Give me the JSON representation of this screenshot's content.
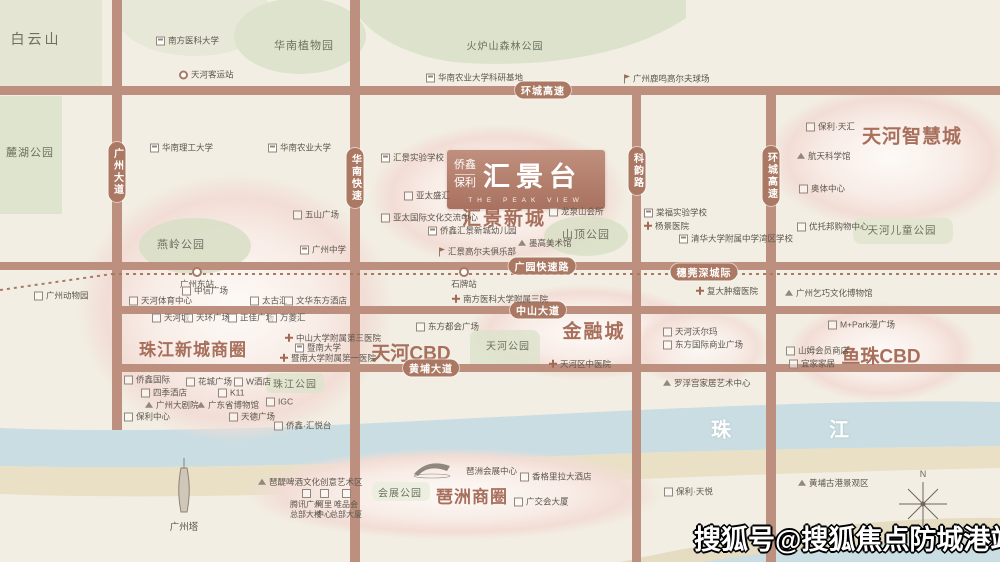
{
  "watermark": {
    "text": "搜狐号@搜狐焦点防城港站"
  },
  "compass": {
    "north_label": "N"
  },
  "logo": {
    "brand_top": "侨鑫",
    "brand_bottom": "保利",
    "name": "汇景台",
    "subtitle": "THE PEAK VIEW"
  },
  "colors": {
    "background": "#f2eee3",
    "road": "#bd8f7e",
    "road_pill": "#ab7963",
    "district_text": "#a8705c",
    "park_green": "#dfe4ce",
    "blob_pink": "#f2ddd5",
    "river": "#c9dde2",
    "sand": "#e9e0c6",
    "poi_text": "#5d574e",
    "watermark_fill": "#ffffff",
    "watermark_outline": "#000000"
  },
  "districts": [
    {
      "text": "汇景新城",
      "x": 504,
      "y": 217,
      "size": 19,
      "ls": 2
    },
    {
      "text": "天河智慧城",
      "x": 912,
      "y": 135,
      "size": 19,
      "ls": 1
    },
    {
      "text": "珠江新城商圈",
      "x": 193,
      "y": 348,
      "size": 17,
      "ls": 1
    },
    {
      "text": "天河CBD",
      "x": 411,
      "y": 352,
      "size": 19,
      "ls": 0
    },
    {
      "text": "金融城",
      "x": 594,
      "y": 330,
      "size": 19,
      "ls": 2
    },
    {
      "text": "鱼珠CBD",
      "x": 881,
      "y": 355,
      "size": 19,
      "ls": 0
    },
    {
      "text": "琶洲商圈",
      "x": 472,
      "y": 495,
      "size": 17,
      "ls": 1
    }
  ],
  "parks": [
    {
      "text": "白云山",
      "x": 36,
      "y": 39,
      "size": 14,
      "ls": 3
    },
    {
      "text": "华南植物园",
      "x": 304,
      "y": 45,
      "size": 11,
      "ls": 1
    },
    {
      "text": "火炉山森林公园",
      "x": 505,
      "y": 45,
      "size": 10,
      "ls": 1
    },
    {
      "text": "麓湖公园",
      "x": 30,
      "y": 152,
      "size": 11,
      "ls": 1
    },
    {
      "text": "燕岭公园",
      "x": 181,
      "y": 244,
      "size": 11,
      "ls": 1
    },
    {
      "text": "山顶公园",
      "x": 586,
      "y": 234,
      "size": 11,
      "ls": 1
    },
    {
      "text": "天河公园",
      "x": 508,
      "y": 345,
      "size": 10,
      "ls": 1
    },
    {
      "text": "珠江公园",
      "x": 295,
      "y": 383,
      "size": 10,
      "ls": 1
    },
    {
      "text": "天河儿童公园",
      "x": 902,
      "y": 230,
      "size": 10.5,
      "ls": 1
    },
    {
      "text": "会展公园",
      "x": 400,
      "y": 492,
      "size": 10,
      "ls": 1
    }
  ],
  "road_labels": [
    {
      "text": "环城高速",
      "x": 543,
      "y": 90,
      "orient": "h"
    },
    {
      "text": "环城高速",
      "x": 771,
      "y": 176,
      "orient": "v"
    },
    {
      "text": "广州大道",
      "x": 117,
      "y": 172,
      "orient": "v"
    },
    {
      "text": "华南快速",
      "x": 355,
      "y": 178,
      "orient": "v"
    },
    {
      "text": "科韵路",
      "x": 637,
      "y": 171,
      "orient": "v"
    },
    {
      "text": "广园快速路",
      "x": 542,
      "y": 266,
      "orient": "h"
    },
    {
      "text": "穗莞深城际",
      "x": 704,
      "y": 272,
      "orient": "h"
    },
    {
      "text": "中山大道",
      "x": 538,
      "y": 310,
      "orient": "h"
    },
    {
      "text": "黄埔大道",
      "x": 431,
      "y": 368,
      "orient": "h"
    }
  ],
  "stations": [
    {
      "label": "广州东站",
      "x": 197,
      "y": 272
    },
    {
      "label": "石牌站",
      "x": 464,
      "y": 272
    }
  ],
  "river_labels": [
    {
      "text": "珠",
      "x": 722,
      "y": 428
    },
    {
      "text": "江",
      "x": 840,
      "y": 428
    }
  ],
  "landmark_labels": [
    {
      "text": "广州塔",
      "x": 184,
      "y": 526
    }
  ],
  "pois": [
    {
      "l": "南方医科大学",
      "x": 156,
      "y": 41,
      "ic": "school"
    },
    {
      "l": "天河客运站",
      "x": 179,
      "y": 75,
      "ic": "station"
    },
    {
      "l": "华南农业大学科研基地",
      "x": 426,
      "y": 78,
      "ic": "school"
    },
    {
      "l": "广州鹿鸣高尔夫球场",
      "x": 622,
      "y": 79,
      "ic": "golf"
    },
    {
      "l": "华南理工大学",
      "x": 150,
      "y": 148,
      "ic": "school"
    },
    {
      "l": "华南农业大学",
      "x": 268,
      "y": 148,
      "ic": "school"
    },
    {
      "l": "五山广场",
      "x": 293,
      "y": 215,
      "ic": "building"
    },
    {
      "l": "广州中学",
      "x": 300,
      "y": 250,
      "ic": "school"
    },
    {
      "l": "汇景实验学校",
      "x": 381,
      "y": 158,
      "ic": "school"
    },
    {
      "l": "亚太盛汇",
      "x": 404,
      "y": 196,
      "ic": "building"
    },
    {
      "l": "亚太国际文化交流中心",
      "x": 381,
      "y": 218,
      "ic": "building"
    },
    {
      "l": "侨鑫汇景新城幼儿园",
      "x": 428,
      "y": 231,
      "ic": "school"
    },
    {
      "l": "汇景高尔夫俱乐部",
      "x": 437,
      "y": 252,
      "ic": "golf"
    },
    {
      "l": "龙泉山会所",
      "x": 549,
      "y": 212,
      "ic": "building"
    },
    {
      "l": "墨高美术馆",
      "x": 518,
      "y": 243,
      "ic": "landmark"
    },
    {
      "l": "棠福实验学校",
      "x": 644,
      "y": 213,
      "ic": "school"
    },
    {
      "l": "杨景医院",
      "x": 644,
      "y": 226,
      "ic": "hospital"
    },
    {
      "l": "清华大学附属中学湾区学校",
      "x": 679,
      "y": 239,
      "ic": "school"
    },
    {
      "l": "保利·天汇",
      "x": 806,
      "y": 127,
      "ic": "building"
    },
    {
      "l": "航天科学馆",
      "x": 797,
      "y": 156,
      "ic": "landmark"
    },
    {
      "l": "奥体中心",
      "x": 799,
      "y": 189,
      "ic": "building"
    },
    {
      "l": "优托邦购物中心",
      "x": 797,
      "y": 227,
      "ic": "building"
    },
    {
      "l": "广州动物园",
      "x": 34,
      "y": 296,
      "ic": "building"
    },
    {
      "l": "中信广场",
      "x": 182,
      "y": 291,
      "ic": "building"
    },
    {
      "l": "天河体育中心",
      "x": 129,
      "y": 301,
      "ic": "building"
    },
    {
      "l": "太古汇",
      "x": 250,
      "y": 301,
      "ic": "building"
    },
    {
      "l": "文华东方酒店",
      "x": 284,
      "y": 301,
      "ic": "building"
    },
    {
      "l": "天河城",
      "x": 152,
      "y": 318,
      "ic": "building"
    },
    {
      "l": "天环广场",
      "x": 184,
      "y": 318,
      "ic": "building"
    },
    {
      "l": "正佳广场",
      "x": 228,
      "y": 318,
      "ic": "building"
    },
    {
      "l": "万菱汇",
      "x": 268,
      "y": 318,
      "ic": "building"
    },
    {
      "l": "中山大学附属第三医院",
      "x": 285,
      "y": 338,
      "ic": "hospital"
    },
    {
      "l": "暨南大学",
      "x": 295,
      "y": 348,
      "ic": "school"
    },
    {
      "l": "暨南大学附属第一医院",
      "x": 280,
      "y": 358,
      "ic": "hospital"
    },
    {
      "l": "侨鑫国际",
      "x": 124,
      "y": 380,
      "ic": "building"
    },
    {
      "l": "花城广场",
      "x": 186,
      "y": 382,
      "ic": "building"
    },
    {
      "l": "W酒店",
      "x": 234,
      "y": 382,
      "ic": "building"
    },
    {
      "l": "四季酒店",
      "x": 141,
      "y": 393,
      "ic": "building"
    },
    {
      "l": "K11",
      "x": 218,
      "y": 393,
      "ic": "building"
    },
    {
      "l": "广州大剧院",
      "x": 145,
      "y": 405,
      "ic": "landmark"
    },
    {
      "l": "广东省博物馆",
      "x": 197,
      "y": 405,
      "ic": "landmark"
    },
    {
      "l": "IGC",
      "x": 266,
      "y": 402,
      "ic": "building"
    },
    {
      "l": "保利中心",
      "x": 124,
      "y": 417,
      "ic": "building"
    },
    {
      "l": "天德广场",
      "x": 229,
      "y": 417,
      "ic": "building"
    },
    {
      "l": "侨鑫·汇悦台",
      "x": 274,
      "y": 426,
      "ic": "building"
    },
    {
      "l": "南方医科大学附属三院",
      "x": 452,
      "y": 299,
      "ic": "hospital"
    },
    {
      "l": "东方都会广场",
      "x": 416,
      "y": 327,
      "ic": "building"
    },
    {
      "l": "天河区中医院",
      "x": 549,
      "y": 364,
      "ic": "hospital"
    },
    {
      "l": "天河沃尔玛",
      "x": 663,
      "y": 332,
      "ic": "building"
    },
    {
      "l": "东方国际商业广场",
      "x": 663,
      "y": 345,
      "ic": "building"
    },
    {
      "l": "罗浮宫家居艺术中心",
      "x": 663,
      "y": 383,
      "ic": "landmark"
    },
    {
      "l": "复大肿瘤医院",
      "x": 696,
      "y": 291,
      "ic": "hospital"
    },
    {
      "l": "广州乞巧文化博物馆",
      "x": 785,
      "y": 293,
      "ic": "landmark"
    },
    {
      "l": "M+Park漫广场",
      "x": 828,
      "y": 325,
      "ic": "building"
    },
    {
      "l": "山姆会员商店",
      "x": 786,
      "y": 351,
      "ic": "building"
    },
    {
      "l": "宜家家居",
      "x": 789,
      "y": 364,
      "ic": "building"
    },
    {
      "l": "琶醍啤酒文化创意艺术区",
      "x": 258,
      "y": 482,
      "ic": "landmark"
    },
    {
      "l": "琶洲会展中心",
      "x": 466,
      "y": 471,
      "ic": "none"
    },
    {
      "l": "香格里拉大酒店",
      "x": 520,
      "y": 477,
      "ic": "building"
    },
    {
      "l": "广交会大厦",
      "x": 514,
      "y": 502,
      "ic": "building"
    },
    {
      "l": "保利·天悦",
      "x": 664,
      "y": 492,
      "ic": "building"
    },
    {
      "l": "黄埔古港景观区",
      "x": 798,
      "y": 483,
      "ic": "landmark"
    },
    {
      "l": "腾讯广州\n总部大楼",
      "x": 306,
      "y": 489,
      "ic": "building",
      "stacked": true
    },
    {
      "l": "阿里\n中心",
      "x": 324,
      "y": 489,
      "ic": "building",
      "stacked": true
    },
    {
      "l": "唯品会\n总部大厦",
      "x": 346,
      "y": 489,
      "ic": "building",
      "stacked": true
    }
  ]
}
